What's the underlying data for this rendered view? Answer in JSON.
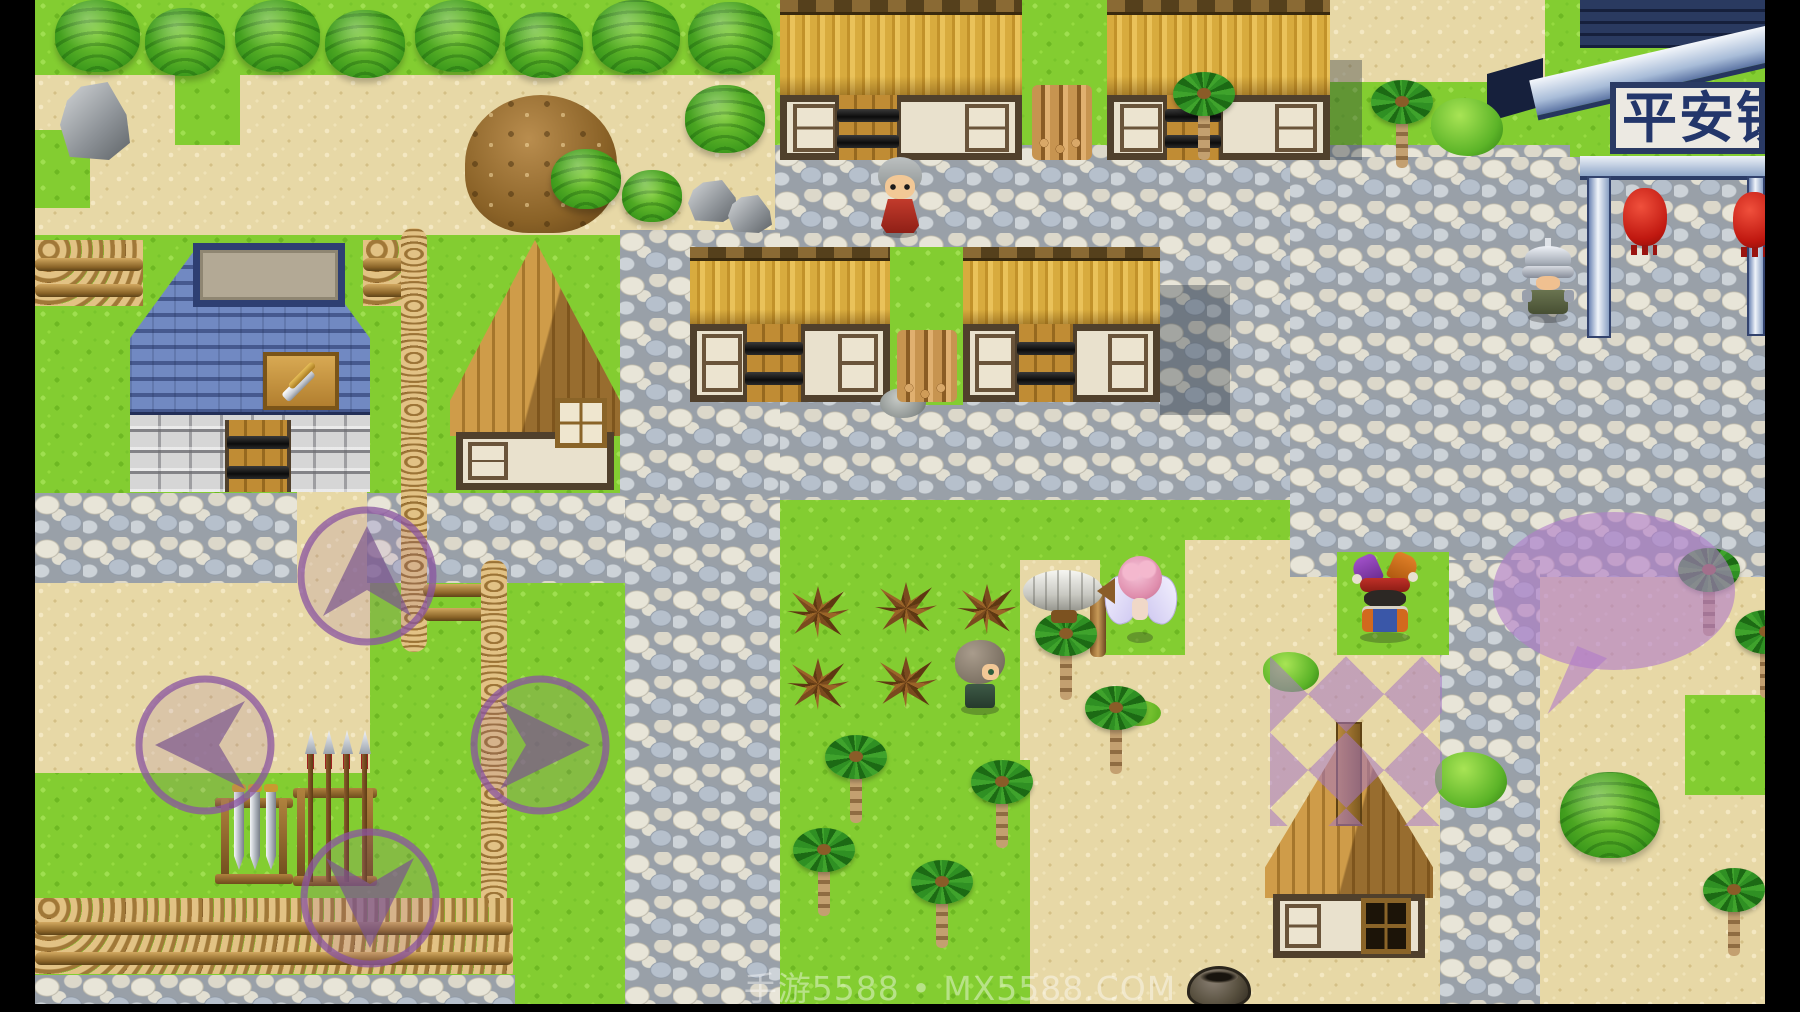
{
  "scene": {
    "type": "rpg-town-overworld",
    "watermark": "手游5588 • MX5588.COM",
    "gate_sign": "平安镇"
  },
  "controls": {
    "dpad": [
      {
        "id": "up",
        "icon": "arrow-up-icon"
      },
      {
        "id": "left",
        "icon": "arrow-left-icon"
      },
      {
        "id": "right",
        "icon": "arrow-right-icon"
      },
      {
        "id": "down",
        "icon": "arrow-down-icon"
      }
    ]
  },
  "entities": {
    "npcs": [
      "elder-red-robe",
      "armored-knight",
      "hero",
      "pink-fairy",
      "jester"
    ],
    "props": [
      "airship",
      "speech-bubble",
      "quest-diamond-marks",
      "firewood-stack",
      "sword-rack",
      "spear-rack",
      "clay-pot",
      "boulder",
      "dirt-mound",
      "red-lanterns",
      "weapon-shop-sword-sign"
    ]
  },
  "palette": {
    "grass": "#83cd31",
    "sand": "#e7d8a6",
    "cobblestone": "#cfd2cc",
    "thatch_roof": "#d7a83c",
    "blue_roof": "#5d7cba",
    "ui_purple": "#9a5fb0",
    "bubble_purple": "#b27cc8",
    "frame_black": "#000000",
    "lantern_red": "#cc1f14",
    "sign_text": "#23366b",
    "watermark_white": "rgba(255,255,255,0.42)"
  }
}
